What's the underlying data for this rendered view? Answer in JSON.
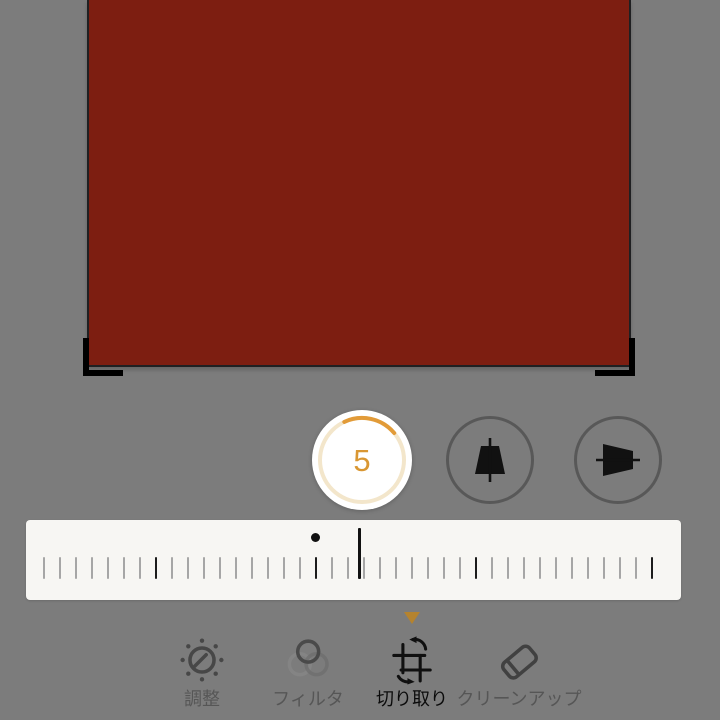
{
  "app": {
    "name": "photo-editor-crop-mode",
    "background_color": "#7c7c7c"
  },
  "canvas": {
    "image_color": "#7d1e11",
    "crop_border_color": "#1f2022",
    "crop_handle_color": "#000000"
  },
  "rotation": {
    "value": "5",
    "accent_color": "#d99733",
    "ring_track_color": "#f3e6cb",
    "ring_arc_color": "#e29b38"
  },
  "perspective_buttons": [
    {
      "icon": "vertical-perspective-icon"
    },
    {
      "icon": "horizontal-perspective-icon"
    }
  ],
  "dial": {
    "bar_color": "#f7f6f3",
    "tick_count": 39,
    "tick_spacing": 16,
    "tick_start": 17,
    "dark_ticks": [
      7,
      17,
      27,
      38
    ],
    "tick_color": "#a6a6a6",
    "dark_tick_color": "#1c1c1c",
    "zero_dot_color": "#111111",
    "indicator_color": "#111111",
    "pointer_color": "#b5832e"
  },
  "toolbar": {
    "items": [
      {
        "label": "調整",
        "icon": "adjust-dial-icon",
        "selected": false
      },
      {
        "label": "フィルタ",
        "icon": "filters-icon",
        "selected": false
      },
      {
        "label": "切り取り",
        "icon": "crop-rotate-icon",
        "selected": true
      },
      {
        "label": "クリーンアップ",
        "icon": "cleanup-eraser-icon",
        "selected": false
      }
    ]
  }
}
